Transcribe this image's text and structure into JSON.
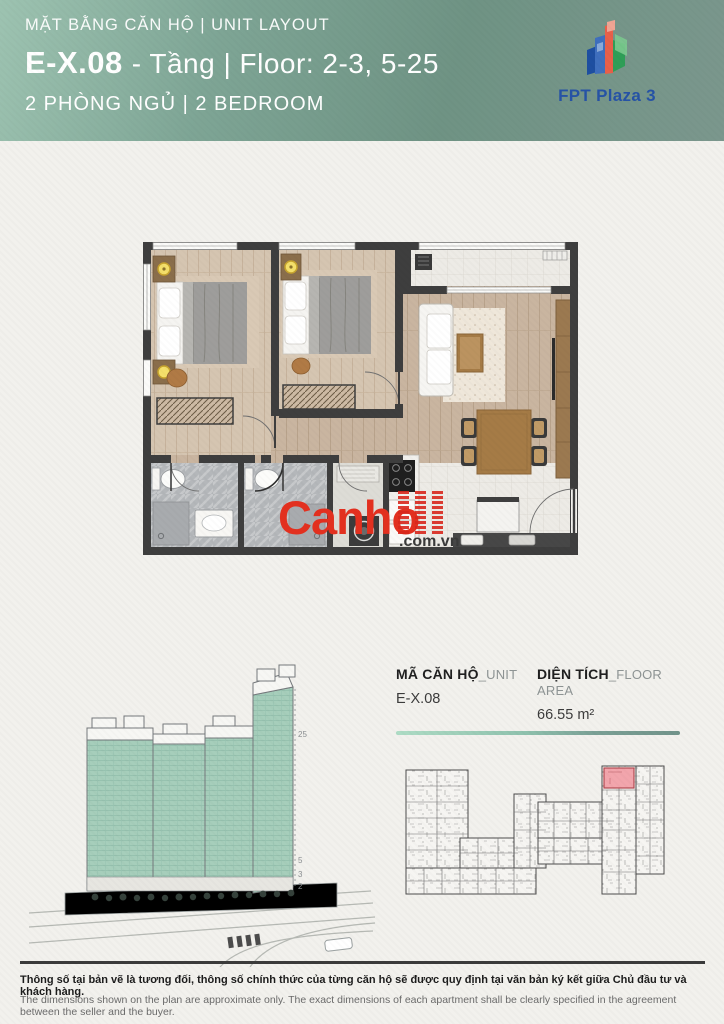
{
  "header": {
    "eyebrow": "MẶT BẰNG CĂN HỘ | UNIT LAYOUT",
    "unit_code": "E-X.08",
    "title_rest": "- Tầng | Floor: 2-3, 5-25",
    "subtitle": "2 PHÒNG NGỦ | 2 BEDROOM",
    "logo_text": "FPT Plaza 3"
  },
  "watermark": {
    "brand": "Canho",
    "suffix": ".com.vn"
  },
  "info": {
    "unit": {
      "label_primary": "MÃ CĂN HỘ",
      "label_secondary": "_UNIT",
      "value": "E-X.08"
    },
    "area": {
      "label_primary": "DIỆN TÍCH",
      "label_secondary": "_FLOOR AREA",
      "value": "66.55 m²"
    }
  },
  "building": {
    "floor_labels": [
      "25",
      "5",
      "3",
      "2"
    ]
  },
  "footer": {
    "disclaimer_vi": "Thông số tại bản vẽ là tương đối, thông số chính thức của từng căn hộ sẽ được quy định tại văn bản ký kết giữa Chủ đầu tư và khách hàng.",
    "disclaimer_en": "The dimensions shown on the plan are approximate only. The exact dimensions of each apartment shall be clearly specified in the agreement between the seller and the buyer."
  },
  "colors": {
    "header_gradient_start": "#9dc3b1",
    "header_gradient_end": "#75948a",
    "accent_green": "#8fc2ae",
    "watermark_red": "#e2301f",
    "keyplan_highlight": "#f2a5ac",
    "building_green": "#a6cebb"
  }
}
